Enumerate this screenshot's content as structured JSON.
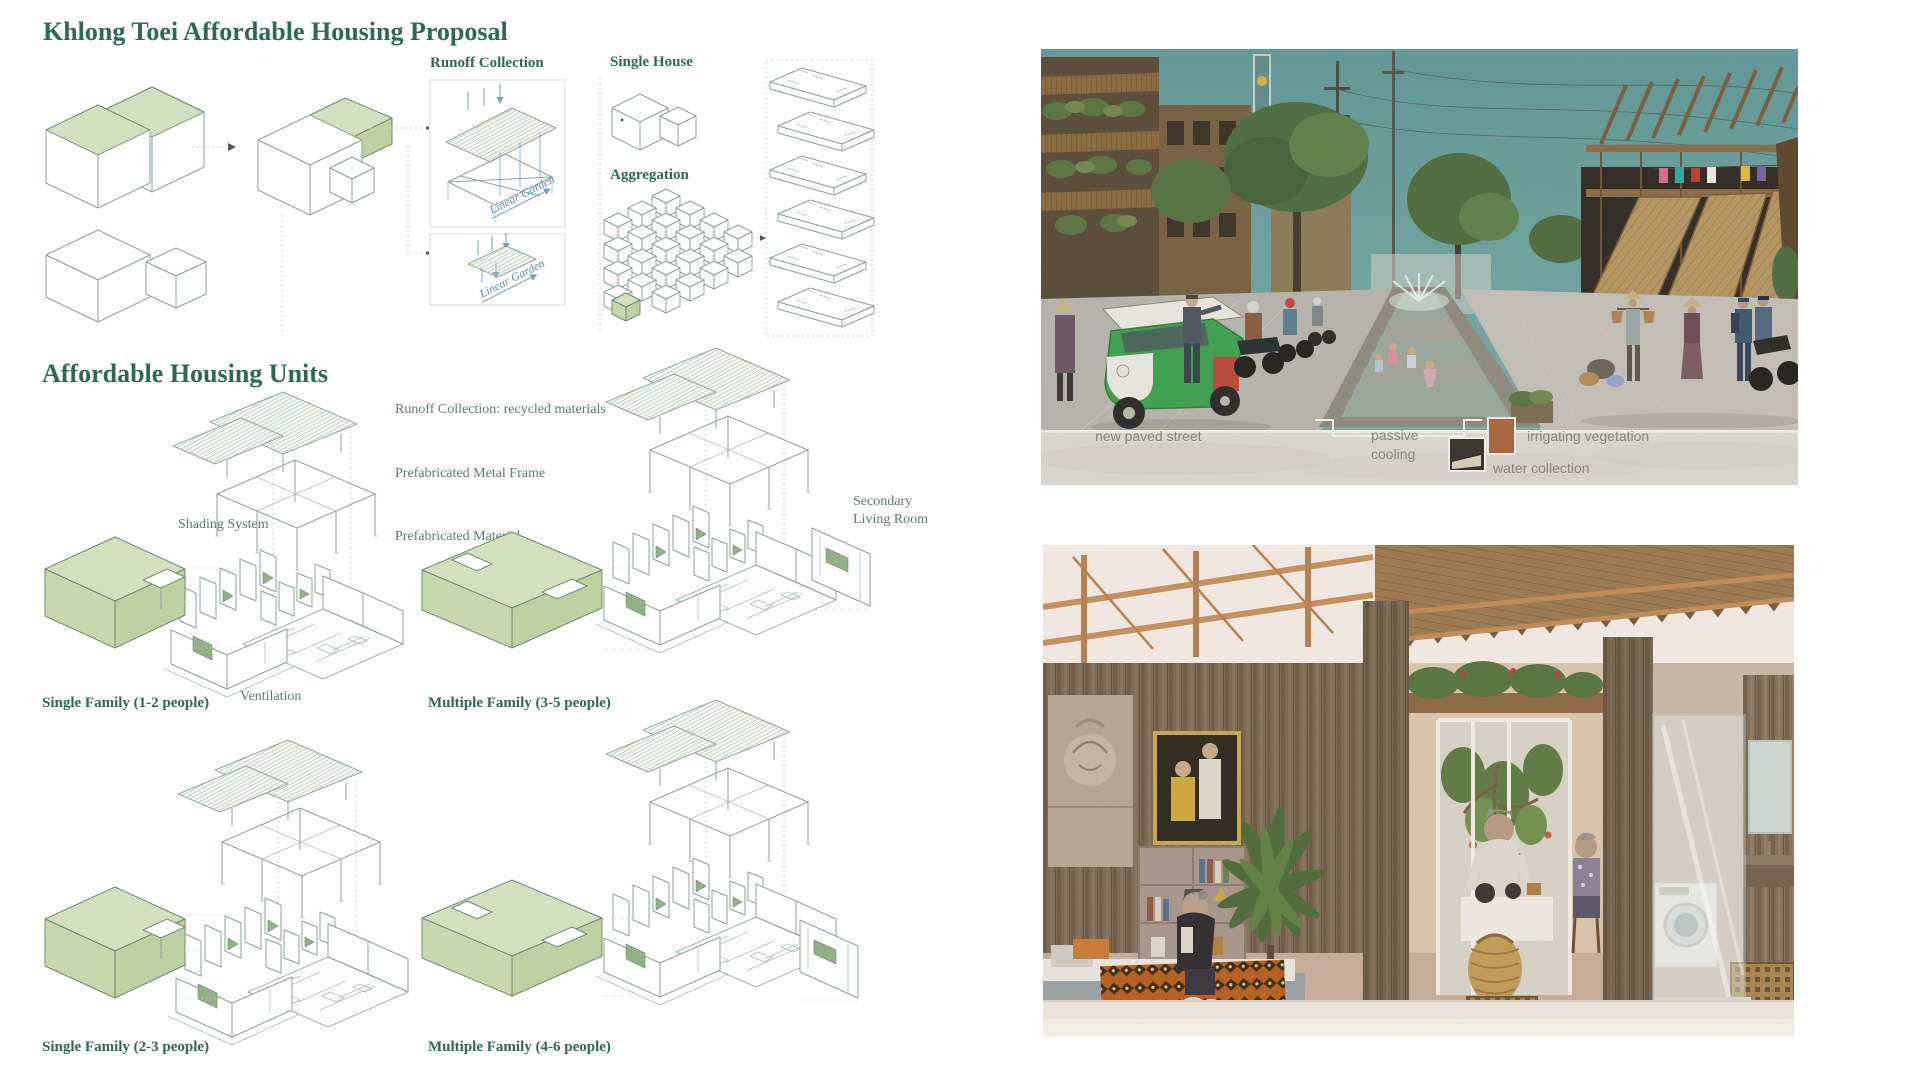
{
  "title": "Khlong Toei Affordable Housing Proposal",
  "process": {
    "runoff_collection": "Runoff Collection",
    "linear_garden": "Linear Garden",
    "single_house": "Single House",
    "aggregation": "Aggregation"
  },
  "units": {
    "heading": "Affordable Housing Units",
    "callout_runoff": "Runoff Collection: recycled materials",
    "callout_frame": "Prefabricated Metal Frame",
    "callout_material": "Prefabricated Material",
    "callout_shading": "Shading System",
    "callout_ventilation": "Ventilation",
    "callout_secondary_1": "Secondary",
    "callout_secondary_2": "Living Room",
    "type_1": "Single Family (1-2 people)",
    "type_2": "Multiple Family (3-5 people)",
    "type_3": "Single Family (2-3 people)",
    "type_4": "Multiple Family (4-6 people)"
  },
  "street_render": {
    "label_street": "new paved street",
    "label_passive_1": "passive",
    "label_passive_2": "cooling",
    "label_irrigating": "irrigating vegetation",
    "label_water": "water collection"
  },
  "colors": {
    "heading_green": "#2e6a4e",
    "callout_green": "#5d7b6b",
    "sage_fill": "#cddcb6",
    "diagram_line_green": "#8ba393",
    "annotation_blue": "#5b8cc4",
    "render_label_gray": "#85817a",
    "sky_teal": "#639b98"
  }
}
